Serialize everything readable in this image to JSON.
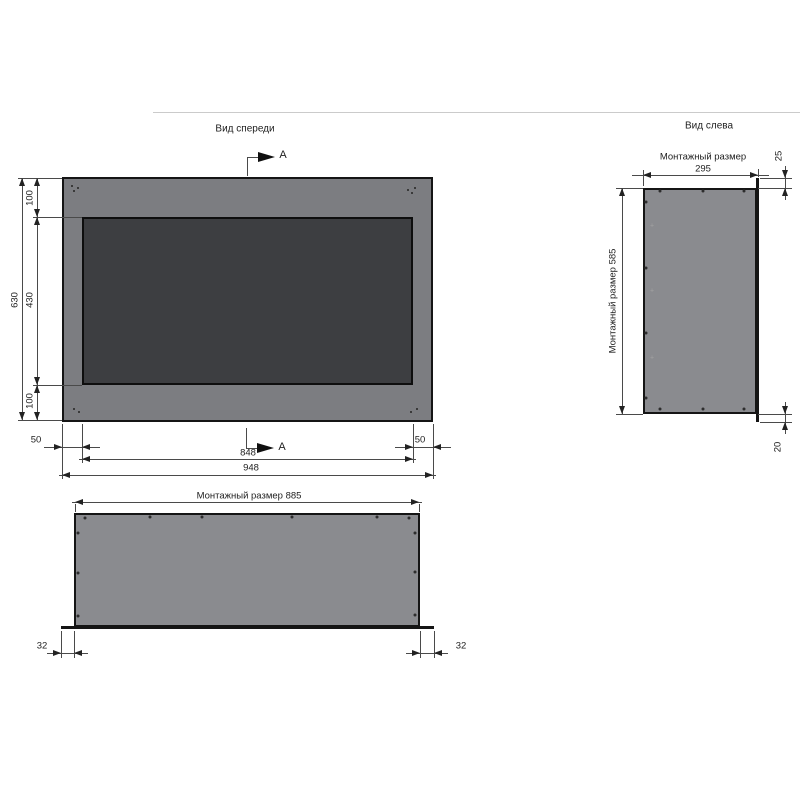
{
  "drawing": {
    "front_view": {
      "title": "Вид спереди",
      "section_label": "A",
      "dim_total_height": "630",
      "dim_top_border": "100",
      "dim_opening_height": "430",
      "dim_bottom_border": "100",
      "dim_left_border": "50",
      "dim_right_border": "50",
      "dim_opening_width": "848",
      "dim_total_width": "948"
    },
    "bottom_view": {
      "dim_mount_width": "Монтажный размер 885",
      "dim_flange_left": "32",
      "dim_flange_right": "32"
    },
    "left_view": {
      "title": "Вид слева",
      "mount_depth_label": "Монтажный размер",
      "mount_depth_value": "295",
      "dim_mount_height": "Монтажный размер 585",
      "dim_top_offset": "25",
      "dim_bottom_offset": "20"
    },
    "colors": {
      "panel_gray": "#7c7d81",
      "firebox_dark": "#3d3e41",
      "body_gray": "#8a8b8f",
      "line_color": "#4a4a4a"
    }
  }
}
